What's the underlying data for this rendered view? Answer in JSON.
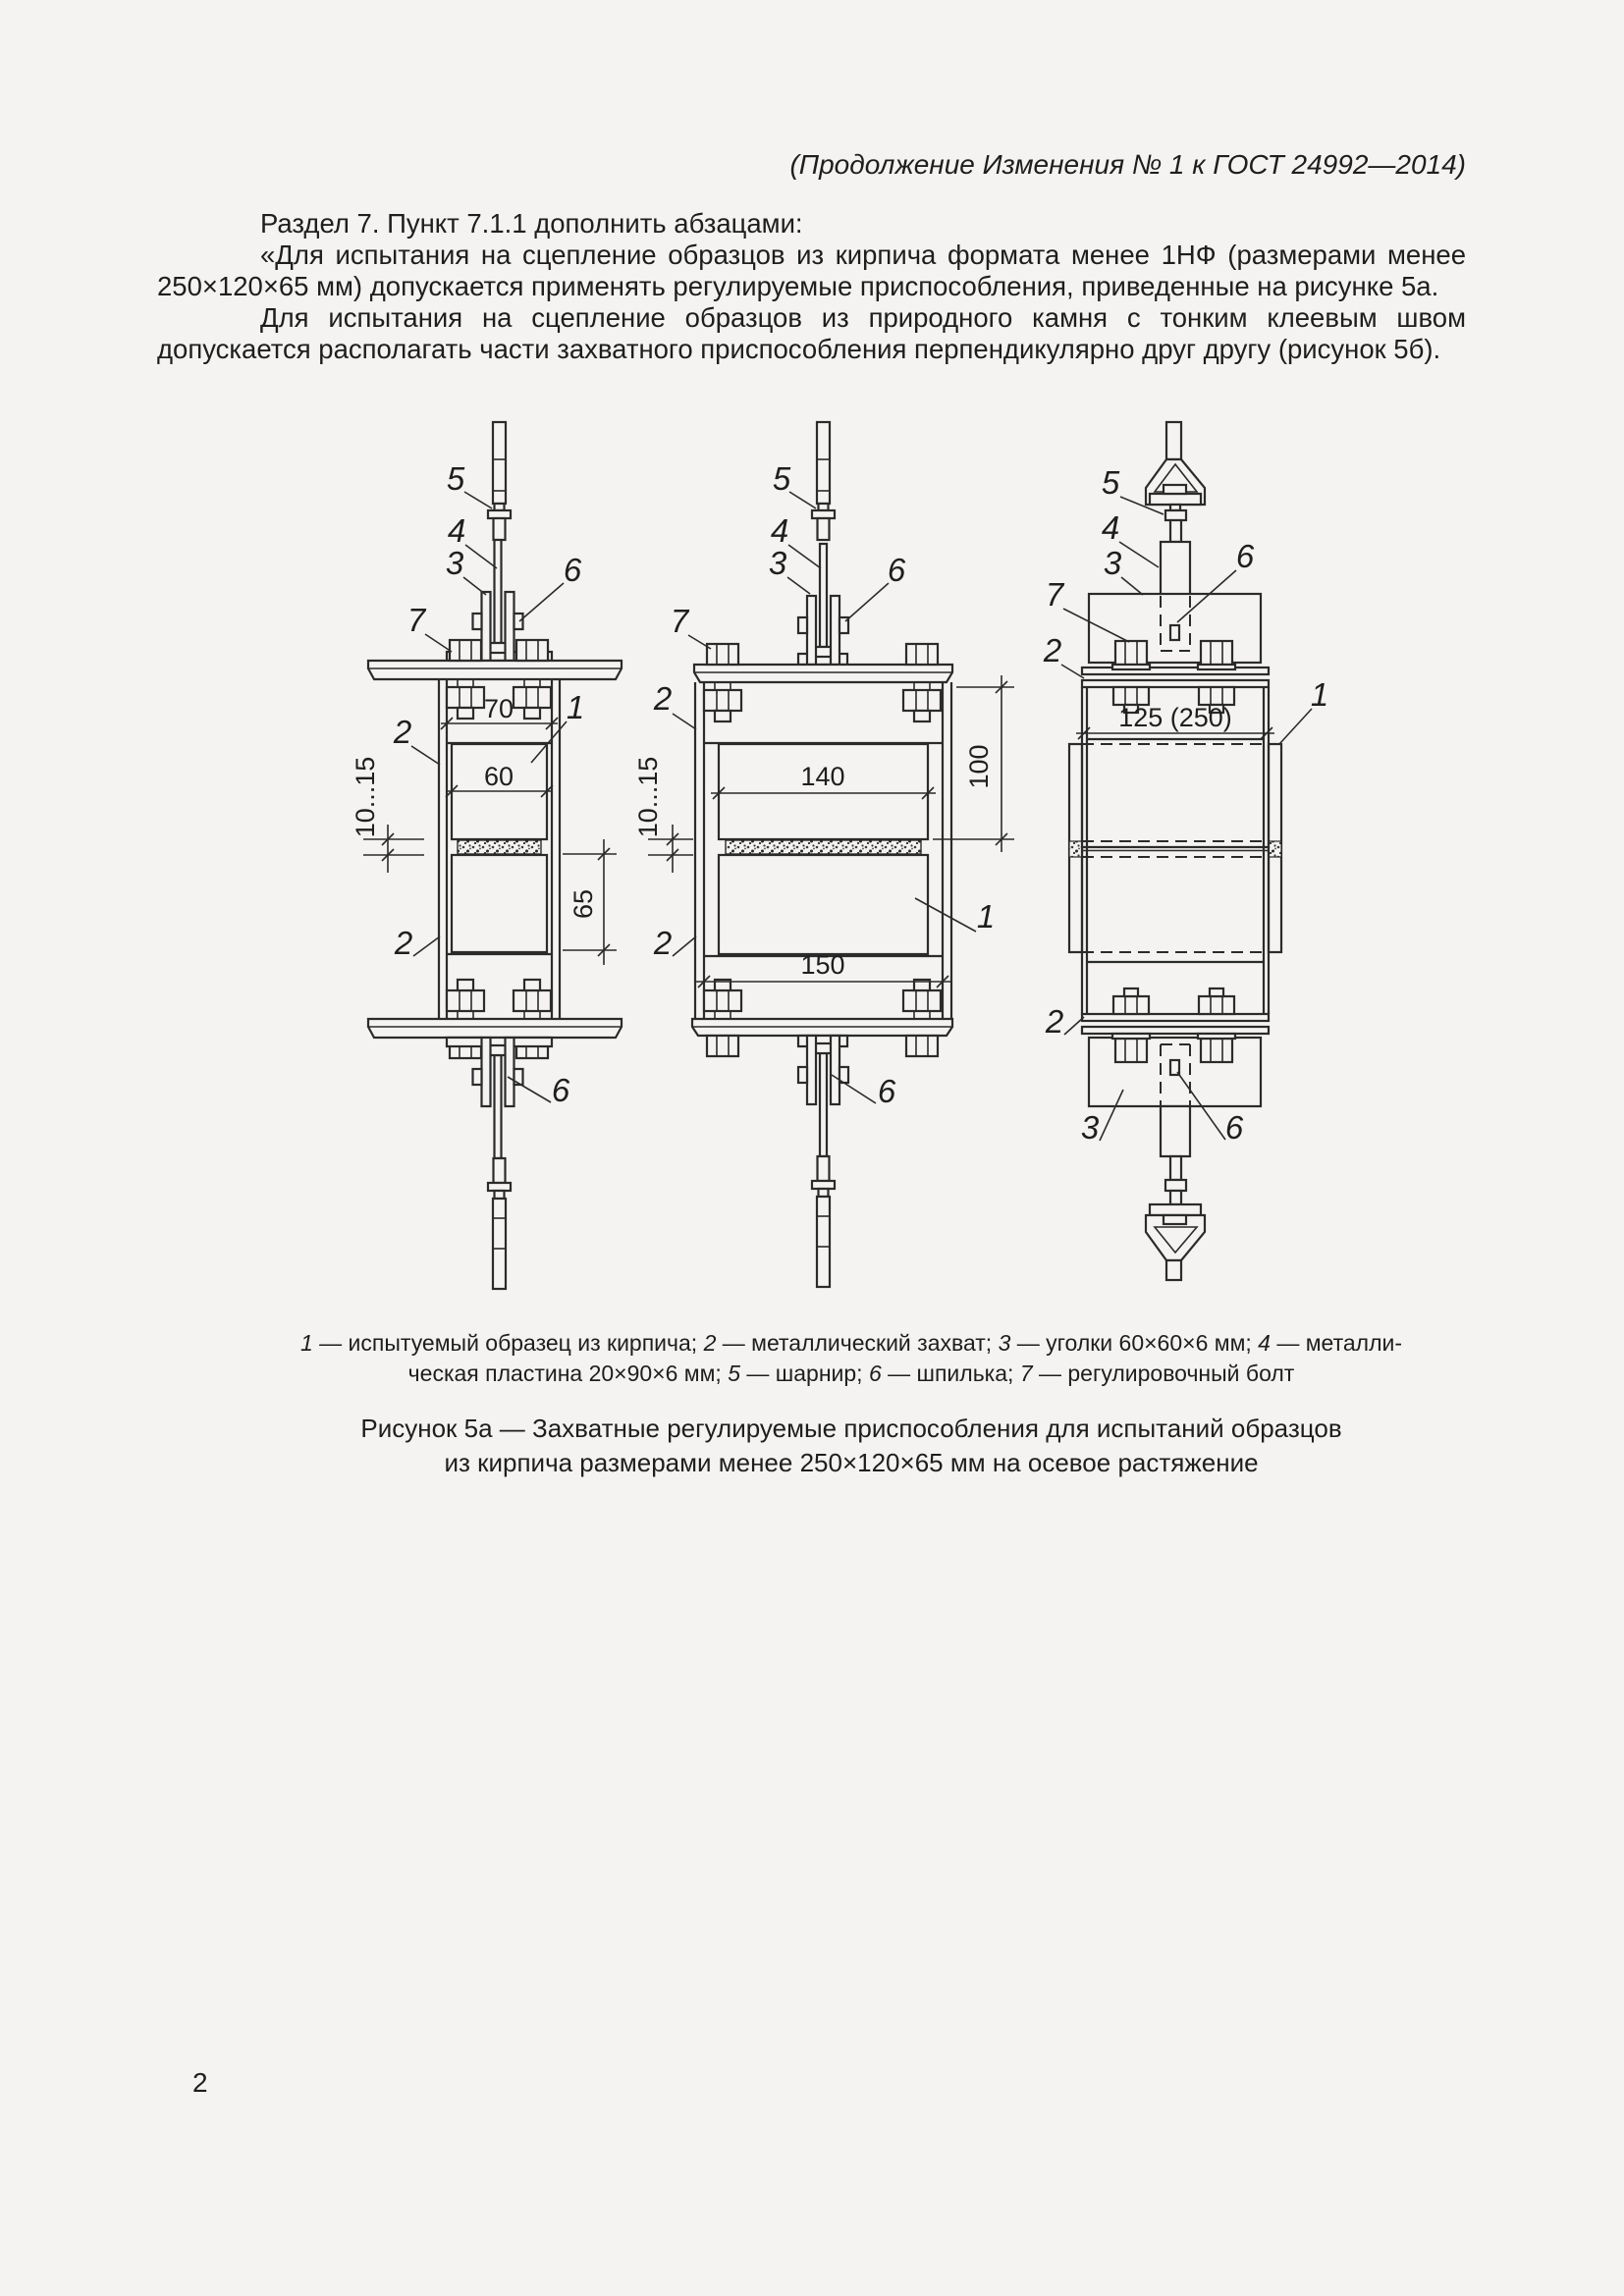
{
  "page": {
    "header": "(Продолжение Изменения № 1 к ГОСТ 24992—2014)",
    "para1": "Раздел 7. Пункт 7.1.1 дополнить абзацами:",
    "para2": "«Для испытания на сцепление образцов из кирпича формата менее 1НФ (размерами менее 250×120×65 мм) допускается применять регулируемые приспособления, приведенные на рисунке 5а.",
    "para3": "Для испытания на сцепление образцов из природного камня с тонким клеевым швом допускается располагать части захватного приспособления перпендикулярно друг другу (рисунок 5б).",
    "page_number": "2"
  },
  "legend": {
    "n1": "1",
    "t1": " — испытуемый образец из кирпича; ",
    "n2": "2",
    "t2": " — металлический захват; ",
    "n3": "3",
    "t3": " — уголки 60×60×6 мм; ",
    "n4": "4",
    "t4a": " — металли-",
    "t4b": "ческая пластина 20×90×6 мм; ",
    "n5": "5",
    "t5": " — шарнир; ",
    "n6": "6",
    "t6": " — шпилька; ",
    "n7": "7",
    "t7": " — регулировочный болт"
  },
  "caption": {
    "line1": "Рисунок 5а — Захватные регулируемые приспособления для испытаний образцов",
    "line2": "из кирпича размерами менее 250×120×65 мм на осевое растяжение"
  },
  "fig": {
    "a": {
      "c1": "1",
      "c2": "2",
      "c2b": "2",
      "c3": "3",
      "c4": "4",
      "c5": "5",
      "c6": "6",
      "c6b": "6",
      "c7": "7",
      "d70": "70",
      "d60": "60",
      "djoint": "10...15",
      "d65": "65"
    },
    "b": {
      "c1": "1",
      "c2": "2",
      "c2b": "2",
      "c3": "3",
      "c4": "4",
      "c5": "5",
      "c6": "6",
      "c6b": "6",
      "c7": "7",
      "d140": "140",
      "d100": "100",
      "djoint": "10...15",
      "d150": "150"
    },
    "c": {
      "c1": "1",
      "c2": "2",
      "c2b": "2",
      "c3": "3",
      "c3b": "3",
      "c4": "4",
      "c5": "5",
      "c6": "6",
      "c6b": "6",
      "c7": "7",
      "d125": "125 (250)"
    }
  }
}
